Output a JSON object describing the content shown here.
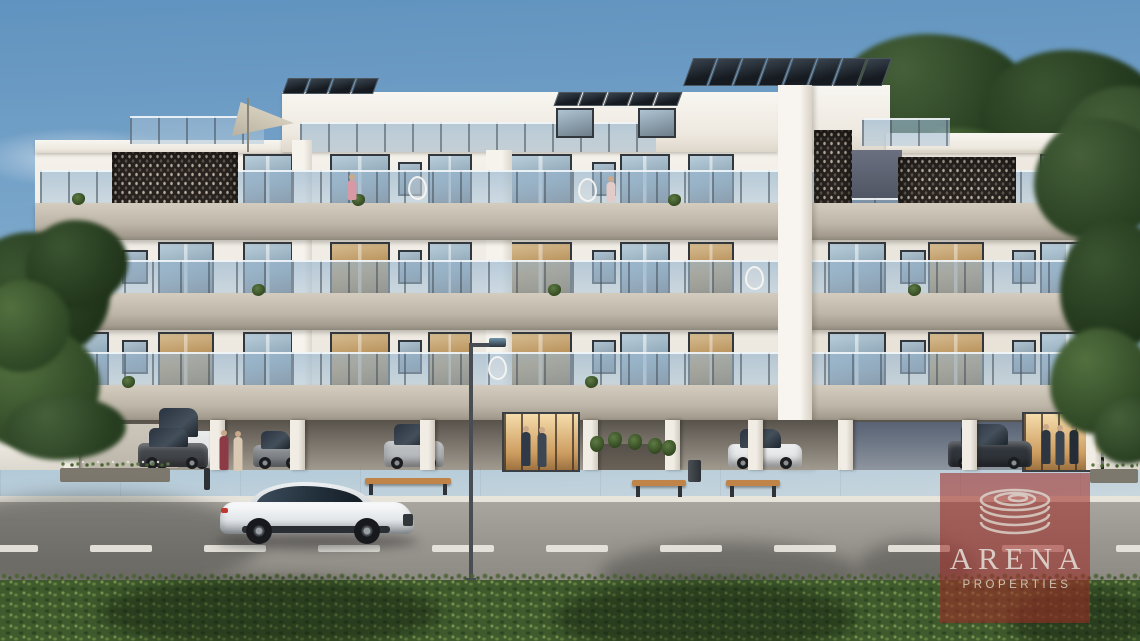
{
  "image": {
    "width": 1140,
    "height": 641,
    "kind": "3d-architectural-exterior-render"
  },
  "watermark": {
    "brand": "ARENA",
    "subtitle": "PROPERTIES",
    "logo_icon": "spiral-rings-icon",
    "overlay_color": "#9E2C28",
    "overlay_opacity": 0.58,
    "text_color": "#E4E0D8"
  },
  "scene": {
    "building_floors_visible": 3,
    "features": [
      "rooftop-solar-panels",
      "roof-terrace-glass-railing",
      "shade-sail",
      "perforated-facade-screens",
      "glass-balcony-railings",
      "floor-to-ceiling-windows",
      "covered-ground-parking",
      "lit-entrance-lobbies",
      "parked-cars",
      "white-sports-car-on-road",
      "street-lamp",
      "road-lane-markings",
      "wooden-benches",
      "flower-planters",
      "foreground-hedge",
      "trees",
      "people-figures"
    ]
  },
  "palette": {
    "sky_top": "#6093BF",
    "sky_mid": "#7FA9CC",
    "sky_low": "#AFC8D8",
    "facade": "#F4F1EA",
    "band": "#BEB6A8",
    "band_dark": "#8E887C",
    "screen": "#282320",
    "glass_cool": "#9DB7C8",
    "glass_warm": "#C09A62",
    "sidewalk": "#D6D2C9",
    "road": "#98948E",
    "lane_mark": "#E9E7E0",
    "hedge": "#3F5A2D",
    "tree": "#3C5330",
    "bench_wood": "#C08348",
    "car_white": "#EDEFF1",
    "warm_light": "#E9C17E"
  }
}
